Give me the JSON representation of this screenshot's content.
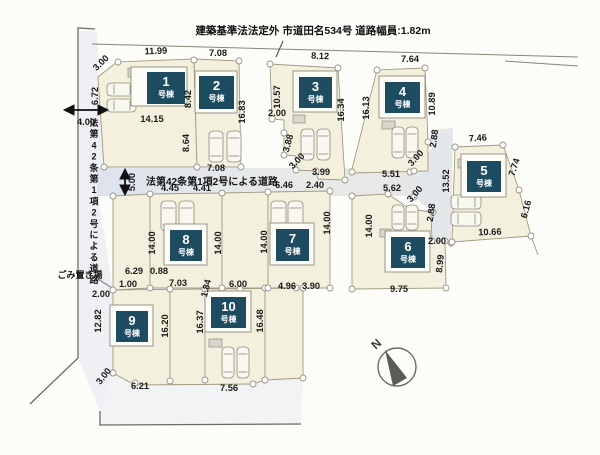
{
  "top_road": {
    "label": "建築基準法法定外 市道田名534号 道路幅員:1.82m"
  },
  "mid_road": {
    "label": "法第42条第1項2号による道路"
  },
  "left_road": {
    "label": "法第42条第1項2号による道路"
  },
  "garbage_label": "ごみ置き場",
  "north": {
    "label": "N"
  },
  "building_suffix": "号棟",
  "colors": {
    "lot_fill": "#f3f1de",
    "road_fill": "#e2e6ee",
    "road_fill2": "#e8eae8",
    "label_box": "#1d4c60",
    "boundary_line": "#a39a82",
    "outer_line": "#6f6a5f"
  },
  "buildings": [
    {
      "num": "1",
      "x": 147,
      "y": 72,
      "w": 38,
      "h": 32,
      "ox": 131,
      "oy": 67,
      "ow": 56,
      "oh": 39
    },
    {
      "num": "2",
      "x": 199,
      "y": 76,
      "w": 35,
      "h": 33,
      "ox": 195,
      "oy": 71,
      "ow": 42,
      "oh": 42
    },
    {
      "num": "3",
      "x": 299,
      "y": 77,
      "w": 33,
      "h": 31,
      "ox": 293,
      "oy": 71,
      "ow": 44,
      "oh": 41
    },
    {
      "num": "4",
      "x": 385,
      "y": 82,
      "w": 35,
      "h": 31,
      "ox": 379,
      "oy": 76,
      "ow": 46,
      "oh": 42
    },
    {
      "num": "5",
      "x": 467,
      "y": 161,
      "w": 34,
      "h": 31,
      "ox": 461,
      "oy": 154,
      "ow": 45,
      "oh": 43
    },
    {
      "num": "8",
      "x": 170,
      "y": 230,
      "w": 32,
      "h": 31,
      "ox": 164,
      "oy": 224,
      "ow": 43,
      "oh": 41
    },
    {
      "num": "7",
      "x": 276,
      "y": 229,
      "w": 33,
      "h": 32,
      "ox": 270,
      "oy": 223,
      "ow": 44,
      "oh": 42
    },
    {
      "num": "6",
      "x": 391,
      "y": 237,
      "w": 34,
      "h": 31,
      "ox": 385,
      "oy": 231,
      "ow": 45,
      "oh": 41
    },
    {
      "num": "9",
      "x": 116,
      "y": 311,
      "w": 32,
      "h": 31,
      "ox": 110,
      "oy": 305,
      "ow": 43,
      "oh": 41
    },
    {
      "num": "10",
      "x": 211,
      "y": 297,
      "w": 35,
      "h": 31,
      "ox": 205,
      "oy": 291,
      "ow": 46,
      "oh": 41
    }
  ],
  "dimensions": [
    {
      "t": "3.00",
      "x": 103,
      "y": 65,
      "r": -44
    },
    {
      "t": "11.99",
      "x": 156,
      "y": 54,
      "r": -2
    },
    {
      "t": "7.08",
      "x": 218,
      "y": 56,
      "r": 0
    },
    {
      "t": "8.12",
      "x": 320,
      "y": 59,
      "r": 2
    },
    {
      "t": "7.64",
      "x": 410,
      "y": 62,
      "r": 0
    },
    {
      "t": "6.72",
      "x": 98,
      "y": 96,
      "r": -90
    },
    {
      "t": "4.00",
      "x": 86,
      "y": 125,
      "r": 0
    },
    {
      "t": "8.42",
      "x": 191,
      "y": 99,
      "r": -90
    },
    {
      "t": "14.15",
      "x": 152,
      "y": 122,
      "r": 0
    },
    {
      "t": "8.64",
      "x": 189,
      "y": 143,
      "r": -90
    },
    {
      "t": "16.83",
      "x": 245,
      "y": 112,
      "r": -90
    },
    {
      "t": "10.57",
      "x": 280,
      "y": 97,
      "r": -90
    },
    {
      "t": "2.00",
      "x": 277,
      "y": 116,
      "r": 0
    },
    {
      "t": "3.88",
      "x": 291,
      "y": 144,
      "r": -75
    },
    {
      "t": "3.00",
      "x": 299,
      "y": 163,
      "r": -46
    },
    {
      "t": "3.99",
      "x": 321,
      "y": 175,
      "r": 0
    },
    {
      "t": "16.34",
      "x": 344,
      "y": 110,
      "r": -90
    },
    {
      "t": "16.13",
      "x": 369,
      "y": 108,
      "r": -90
    },
    {
      "t": "10.89",
      "x": 435,
      "y": 104,
      "r": -90
    },
    {
      "t": "7.46",
      "x": 478,
      "y": 141,
      "r": -4
    },
    {
      "t": "2.88",
      "x": 437,
      "y": 139,
      "r": -82
    },
    {
      "t": "3.00",
      "x": 418,
      "y": 160,
      "r": -48
    },
    {
      "t": "5.51",
      "x": 391,
      "y": 177,
      "r": 0
    },
    {
      "t": "5.62",
      "x": 392,
      "y": 191,
      "r": 0
    },
    {
      "t": "3.00",
      "x": 417,
      "y": 196,
      "r": -48
    },
    {
      "t": "2.88",
      "x": 434,
      "y": 213,
      "r": -82
    },
    {
      "t": "13.52",
      "x": 449,
      "y": 181,
      "r": -90
    },
    {
      "t": "7.74",
      "x": 517,
      "y": 168,
      "r": -72
    },
    {
      "t": "6.16",
      "x": 529,
      "y": 210,
      "r": -75
    },
    {
      "t": "10.66",
      "x": 490,
      "y": 235,
      "r": -2
    },
    {
      "t": "2.00",
      "x": 437,
      "y": 244,
      "r": 0
    },
    {
      "t": "8.99",
      "x": 443,
      "y": 264,
      "r": -84
    },
    {
      "t": "5.00",
      "x": 135,
      "y": 182,
      "r": -90
    },
    {
      "t": "7.08",
      "x": 216,
      "y": 171,
      "r": 0
    },
    {
      "t": "4.45",
      "x": 170,
      "y": 191,
      "r": 0
    },
    {
      "t": "4.41",
      "x": 202,
      "y": 191,
      "r": 0
    },
    {
      "t": "6.46",
      "x": 284,
      "y": 188,
      "r": 0
    },
    {
      "t": "2.40",
      "x": 315,
      "y": 188,
      "r": 0
    },
    {
      "t": "14.00",
      "x": 155,
      "y": 243,
      "r": -90
    },
    {
      "t": "14.00",
      "x": 221,
      "y": 243,
      "r": -90
    },
    {
      "t": "14.00",
      "x": 267,
      "y": 242,
      "r": -90
    },
    {
      "t": "14.00",
      "x": 330,
      "y": 223,
      "r": -90
    },
    {
      "t": "14.00",
      "x": 372,
      "y": 226,
      "r": -90
    },
    {
      "t": "6.29",
      "x": 134,
      "y": 274,
      "r": 0
    },
    {
      "t": "0.88",
      "x": 159,
      "y": 274,
      "r": 0
    },
    {
      "t": "1.00",
      "x": 128,
      "y": 287,
      "r": 0
    },
    {
      "t": "7.03",
      "x": 178,
      "y": 286,
      "r": 0
    },
    {
      "t": "1.84",
      "x": 209,
      "y": 289,
      "r": -76
    },
    {
      "t": "6.00",
      "x": 238,
      "y": 287,
      "r": 0
    },
    {
      "t": "4.96",
      "x": 287,
      "y": 289,
      "r": 0
    },
    {
      "t": "3.90",
      "x": 311,
      "y": 289,
      "r": 0
    },
    {
      "t": "9.75",
      "x": 399,
      "y": 292,
      "r": 0
    },
    {
      "t": "2.00",
      "x": 101,
      "y": 297,
      "r": 0
    },
    {
      "t": "12.82",
      "x": 101,
      "y": 321,
      "r": -90
    },
    {
      "t": "16.20",
      "x": 168,
      "y": 326,
      "r": -90
    },
    {
      "t": "16.37",
      "x": 203,
      "y": 322,
      "r": -90
    },
    {
      "t": "16.48",
      "x": 263,
      "y": 321,
      "r": -90
    },
    {
      "t": "3.00",
      "x": 106,
      "y": 378,
      "r": -52
    },
    {
      "t": "6.21",
      "x": 140,
      "y": 389,
      "r": 0
    },
    {
      "t": "7.56",
      "x": 229,
      "y": 391,
      "r": 0
    }
  ]
}
